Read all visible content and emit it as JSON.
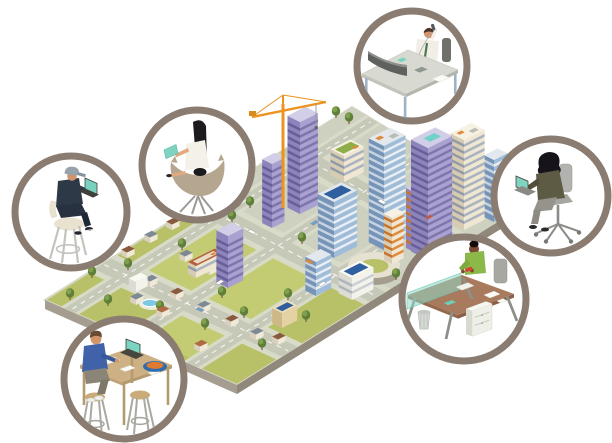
{
  "meta": {
    "title": "Telecommuting illustration",
    "description": "Isometric aerial city map surrounded by six circular vignettes of people working remotely",
    "width": 612,
    "height": 443,
    "background": "#ffffff"
  },
  "palette": {
    "ring": "#8a7c71",
    "ring_fill": "#ffffff",
    "grass": "#b9c168",
    "grass_light": "#c3cc72",
    "road": "#c6c8b8",
    "sidewalk": "#d9dbc9",
    "pavement": "#ced1c0",
    "plate_edge": "#d6d8c6",
    "plate_side": "#a59e90",
    "plate_side_dark": "#8f887b",
    "teal_device": "#7bd3c0",
    "crane_orange": "#ec9320",
    "road_dash": "#ffffff",
    "building_styles": {
      "lavender": {
        "r": "#a9a1cf",
        "l": "#8c84bb",
        "t": "#d2cee8",
        "band": "#7e76ad",
        "bandL": "#685f99"
      },
      "glass": {
        "r": "#9fbcd9",
        "l": "#7693b8",
        "t": "#e3e8ee",
        "band": "#e9eef3",
        "bandL": "#c6d3e0"
      },
      "cream": {
        "r": "#efe7d2",
        "l": "#d7cbb1",
        "t": "#f6f1e2",
        "band": "#aab3bf",
        "bandL": "#909aa8"
      },
      "creamorange": {
        "r": "#f0e8d4",
        "l": "#d8ccb2",
        "t": "#f6f1e2",
        "band": "#e08a3c",
        "bandL": "#c4742e"
      },
      "lavorange": {
        "r": "#a9a1cf",
        "l": "#8c84bb",
        "t": "#d2cee8",
        "band": "#e08a3c",
        "bandL": "#c4742e"
      },
      "white": {
        "r": "#f3f3ec",
        "l": "#dcdcd4",
        "t": "#fafaf4",
        "band": "#c9cfd5",
        "bandL": "#aeb4bc"
      },
      "tan": {
        "r": "#e5d2a4",
        "l": "#cdb886",
        "t": "#eee0bb"
      }
    },
    "house_walls": {
      "r": "#f0e9d8",
      "l": "#d9d1bd"
    },
    "roof_colors": {
      "brown": "#8a5a3e",
      "slate": "#7d8a96",
      "terra": "#b06a42"
    },
    "tree_colors": {
      "crown": "#5f7e3a",
      "light": "#7fa04c",
      "trunk": "#7d5b40"
    },
    "roof_detail": {
      "solar": "#2f5f9e",
      "pool": "#6fd2c8",
      "garden": "#8fae4a",
      "unit": "#b9bdb5",
      "accent": "#e08a3c",
      "mall": "#b65c3f",
      "mall_in": "#e7ddc3"
    }
  },
  "vignettes": [
    {
      "id": "man-on-phone",
      "label": "Businessman taking a phone call at a desk with a curved monitor",
      "position": "top"
    },
    {
      "id": "woman-tablet",
      "label": "Woman with long dark hair reading a teal tablet in a lounge chair",
      "position": "upper-left"
    },
    {
      "id": "man-laptop-stool",
      "label": "Man in a cap working on a teal laptop while seated on a high stool",
      "position": "left"
    },
    {
      "id": "woman-office-chair",
      "label": "Woman with a teal laptop seated in a gray swivel office chair",
      "position": "right"
    },
    {
      "id": "woman-standing-desk",
      "label": "Woman in a green top working at a desk with teal privacy screen, file cabinet and trash can",
      "position": "lower-right"
    },
    {
      "id": "person-cafe-table",
      "label": "Person in a blue sweater on a laptop at a wooden high table with stools and a fruit bowl",
      "position": "lower-left"
    }
  ],
  "city": {
    "label": "Isometric city with downtown towers, construction crane, round plaza, suburbs, pool and tree-lined streets",
    "plate": {
      "corners": {
        "W": [
          45,
          300
        ],
        "N": [
          352,
          107
        ],
        "E": [
          520,
          208
        ],
        "S": [
          237,
          385
        ]
      },
      "side_drop": 9
    },
    "pavement": [
      0.52,
      1.0,
      0.0,
      1.0
    ],
    "grass_patches": [
      [
        0.215,
        0.46,
        0.16,
        0.41
      ],
      [
        0.215,
        0.46,
        0.48,
        0.73
      ],
      [
        0.02,
        0.155,
        0.48,
        0.73
      ]
    ],
    "roads": {
      "b_strips": [
        [
          0.1,
          0.155
        ],
        [
          0.42,
          0.475
        ],
        [
          0.74,
          0.795
        ]
      ],
      "a_strips": [
        [
          0.16,
          0.215
        ],
        [
          0.47,
          0.525
        ],
        [
          0.76,
          0.815
        ]
      ],
      "sidewalk_pad": 0.018
    },
    "buildings": [
      {
        "x": 272,
        "y": 228,
        "w": 14,
        "d": 11,
        "h": 64,
        "style": "lavender"
      },
      {
        "x": 300,
        "y": 214,
        "w": 20,
        "d": 14,
        "h": 92,
        "style": "lavender",
        "roof": "construction"
      },
      {
        "x": 334,
        "y": 258,
        "w": 26,
        "d": 18,
        "h": 56,
        "style": "glass",
        "roof": "solar"
      },
      {
        "x": 344,
        "y": 182,
        "w": 22,
        "d": 15,
        "h": 26,
        "style": "cream",
        "roof": "garden"
      },
      {
        "x": 384,
        "y": 250,
        "w": 24,
        "d": 17,
        "h": 104,
        "style": "glass",
        "roof": "units"
      },
      {
        "x": 428,
        "y": 260,
        "w": 27,
        "d": 19,
        "h": 112,
        "style": "lavender",
        "roof": "pool"
      },
      {
        "x": 464,
        "y": 230,
        "w": 23,
        "d": 15,
        "h": 90,
        "style": "cream",
        "roof": "units"
      },
      {
        "x": 494,
        "y": 222,
        "w": 15,
        "d": 11,
        "h": 62,
        "style": "glass"
      },
      {
        "x": 392,
        "y": 264,
        "w": 13,
        "d": 9,
        "h": 46,
        "style": "creamorange"
      },
      {
        "x": 414,
        "y": 252,
        "w": 13,
        "d": 9,
        "h": 60,
        "style": "lavorange"
      },
      {
        "x": 352,
        "y": 300,
        "w": 24,
        "d": 15,
        "h": 22,
        "style": "white",
        "roof": "solar"
      },
      {
        "x": 316,
        "y": 296,
        "w": 17,
        "d": 12,
        "h": 34,
        "style": "glass"
      },
      {
        "x": 228,
        "y": 288,
        "w": 17,
        "d": 13,
        "h": 52,
        "style": "lavender"
      },
      {
        "x": 196,
        "y": 278,
        "w": 30,
        "d": 9,
        "h": 12,
        "style": "cream",
        "roof": "mallroof"
      },
      {
        "x": 136,
        "y": 292,
        "w": 13,
        "d": 8,
        "h": 10,
        "style": "white"
      },
      {
        "x": 282,
        "y": 328,
        "w": 17,
        "d": 11,
        "h": 15,
        "style": "tan",
        "roof": "solar"
      }
    ],
    "houses": [
      [
        127,
        258,
        "brown"
      ],
      [
        150,
        243,
        "slate"
      ],
      [
        172,
        230,
        "brown"
      ],
      [
        185,
        262,
        "slate"
      ],
      [
        210,
        275,
        "brown"
      ],
      [
        150,
        287,
        "slate"
      ],
      [
        176,
        300,
        "brown"
      ],
      [
        203,
        313,
        "slate"
      ],
      [
        231,
        327,
        "brown"
      ],
      [
        256,
        340,
        "slate"
      ],
      [
        278,
        345,
        "brown"
      ],
      [
        162,
        318,
        "terra"
      ],
      [
        136,
        305,
        "slate"
      ],
      [
        200,
        352,
        "terra"
      ]
    ],
    "trees": [
      [
        70,
        300
      ],
      [
        92,
        278
      ],
      [
        108,
        306
      ],
      [
        128,
        270
      ],
      [
        160,
        312
      ],
      [
        182,
        250
      ],
      [
        205,
        330
      ],
      [
        222,
        298
      ],
      [
        244,
        318
      ],
      [
        262,
        350
      ],
      [
        288,
        300
      ],
      [
        306,
        322
      ],
      [
        250,
        208
      ],
      [
        232,
        222
      ],
      [
        336,
        118
      ],
      [
        349,
        124
      ],
      [
        470,
        200
      ],
      [
        484,
        216
      ],
      [
        396,
        280
      ],
      [
        302,
        244
      ]
    ],
    "vehicles": [
      {
        "t": "b",
        "a": 0.55,
        "b": 0.1275,
        "c": "#e08a3c"
      },
      {
        "t": "b",
        "a": 0.3,
        "b": 0.4475,
        "c": "#ffffff"
      },
      {
        "t": "b",
        "a": 0.62,
        "b": 0.4475,
        "c": "#6aa0d4"
      },
      {
        "t": "b",
        "a": 0.45,
        "b": 0.7675,
        "c": "#ffffff"
      },
      {
        "t": "b",
        "a": 0.82,
        "b": 0.7675,
        "c": "#c85545"
      },
      {
        "t": "a",
        "a": 0.4975,
        "b": 0.3,
        "c": "#ffffff"
      },
      {
        "t": "a",
        "a": 0.4975,
        "b": 0.62,
        "c": "#e08a3c"
      },
      {
        "t": "a",
        "a": 0.7875,
        "b": 0.55,
        "c": "#ffffff"
      },
      {
        "t": "a",
        "a": 0.1875,
        "b": 0.52,
        "c": "#6aa0d4"
      }
    ],
    "crane": {
      "mast": [
        [
          283,
          208
        ],
        [
          283,
          104
        ]
      ],
      "jib": [
        [
          252,
          117
        ],
        [
          326,
          102
        ]
      ],
      "apex": [
        283,
        95
      ],
      "counterweight": [
        249,
        111,
        7,
        5
      ],
      "hook_x": 316,
      "hook_y1": 103,
      "hook_y2": 126
    },
    "plaza": {
      "cx": 374,
      "cy": 268,
      "rx": 26,
      "ry": 13
    },
    "pool": {
      "cx": 150,
      "cy": 303,
      "rx": 8,
      "ry": 3.6,
      "deck_rx": 13,
      "deck_ry": 6,
      "water": "#7cc9e4",
      "deck": "#eceadb"
    }
  }
}
